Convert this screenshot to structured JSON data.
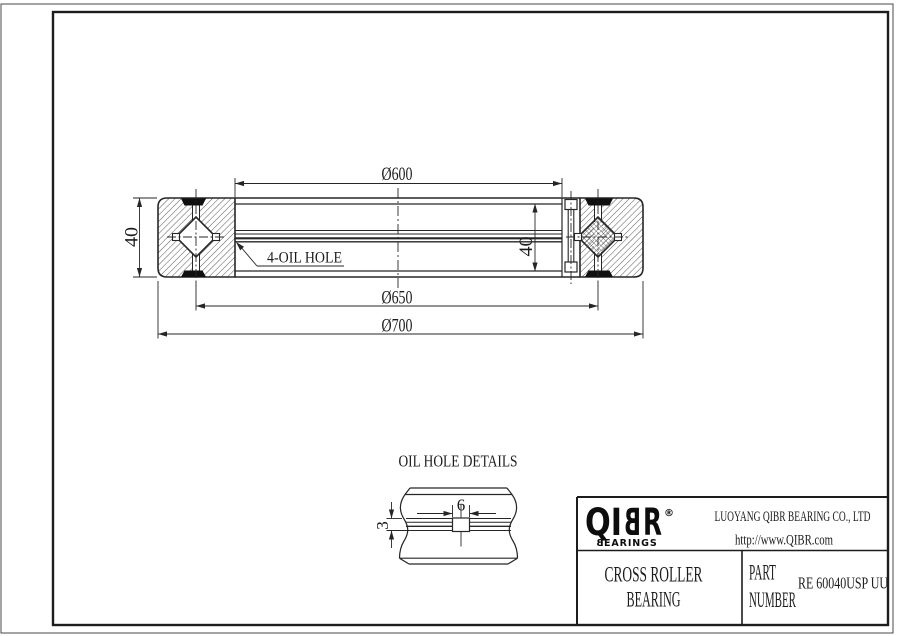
{
  "colors": {
    "line": "#262626",
    "seal_black": "#101010",
    "background": "#ffffff"
  },
  "main_view": {
    "dim_bore": "Ø600",
    "dim_pitch": "Ø650",
    "dim_outer": "Ø700",
    "dim_width_left": "40",
    "dim_width_right": "40",
    "oil_hole_callout": "4-OIL HOLE"
  },
  "detail_view": {
    "title": "OIL HOLE DETAILS",
    "dim_hole_width": "6",
    "dim_hole_depth": "3"
  },
  "title_block": {
    "logo": {
      "part1": "QI",
      "part2_mirrored": "B",
      "part3": "R",
      "registered": "®",
      "sub_first_mirrored": "B",
      "sub_rest": "EARINGS"
    },
    "company": "LUOYANG QIBR BEARING CO., LTD",
    "website": "http://www.QIBR.com",
    "product_line1": "CROSS ROLLER",
    "product_line2": "BEARING",
    "part_label_line1": "PART",
    "part_label_line2": "NUMBER",
    "part_number": "RE 60040USP UU"
  }
}
